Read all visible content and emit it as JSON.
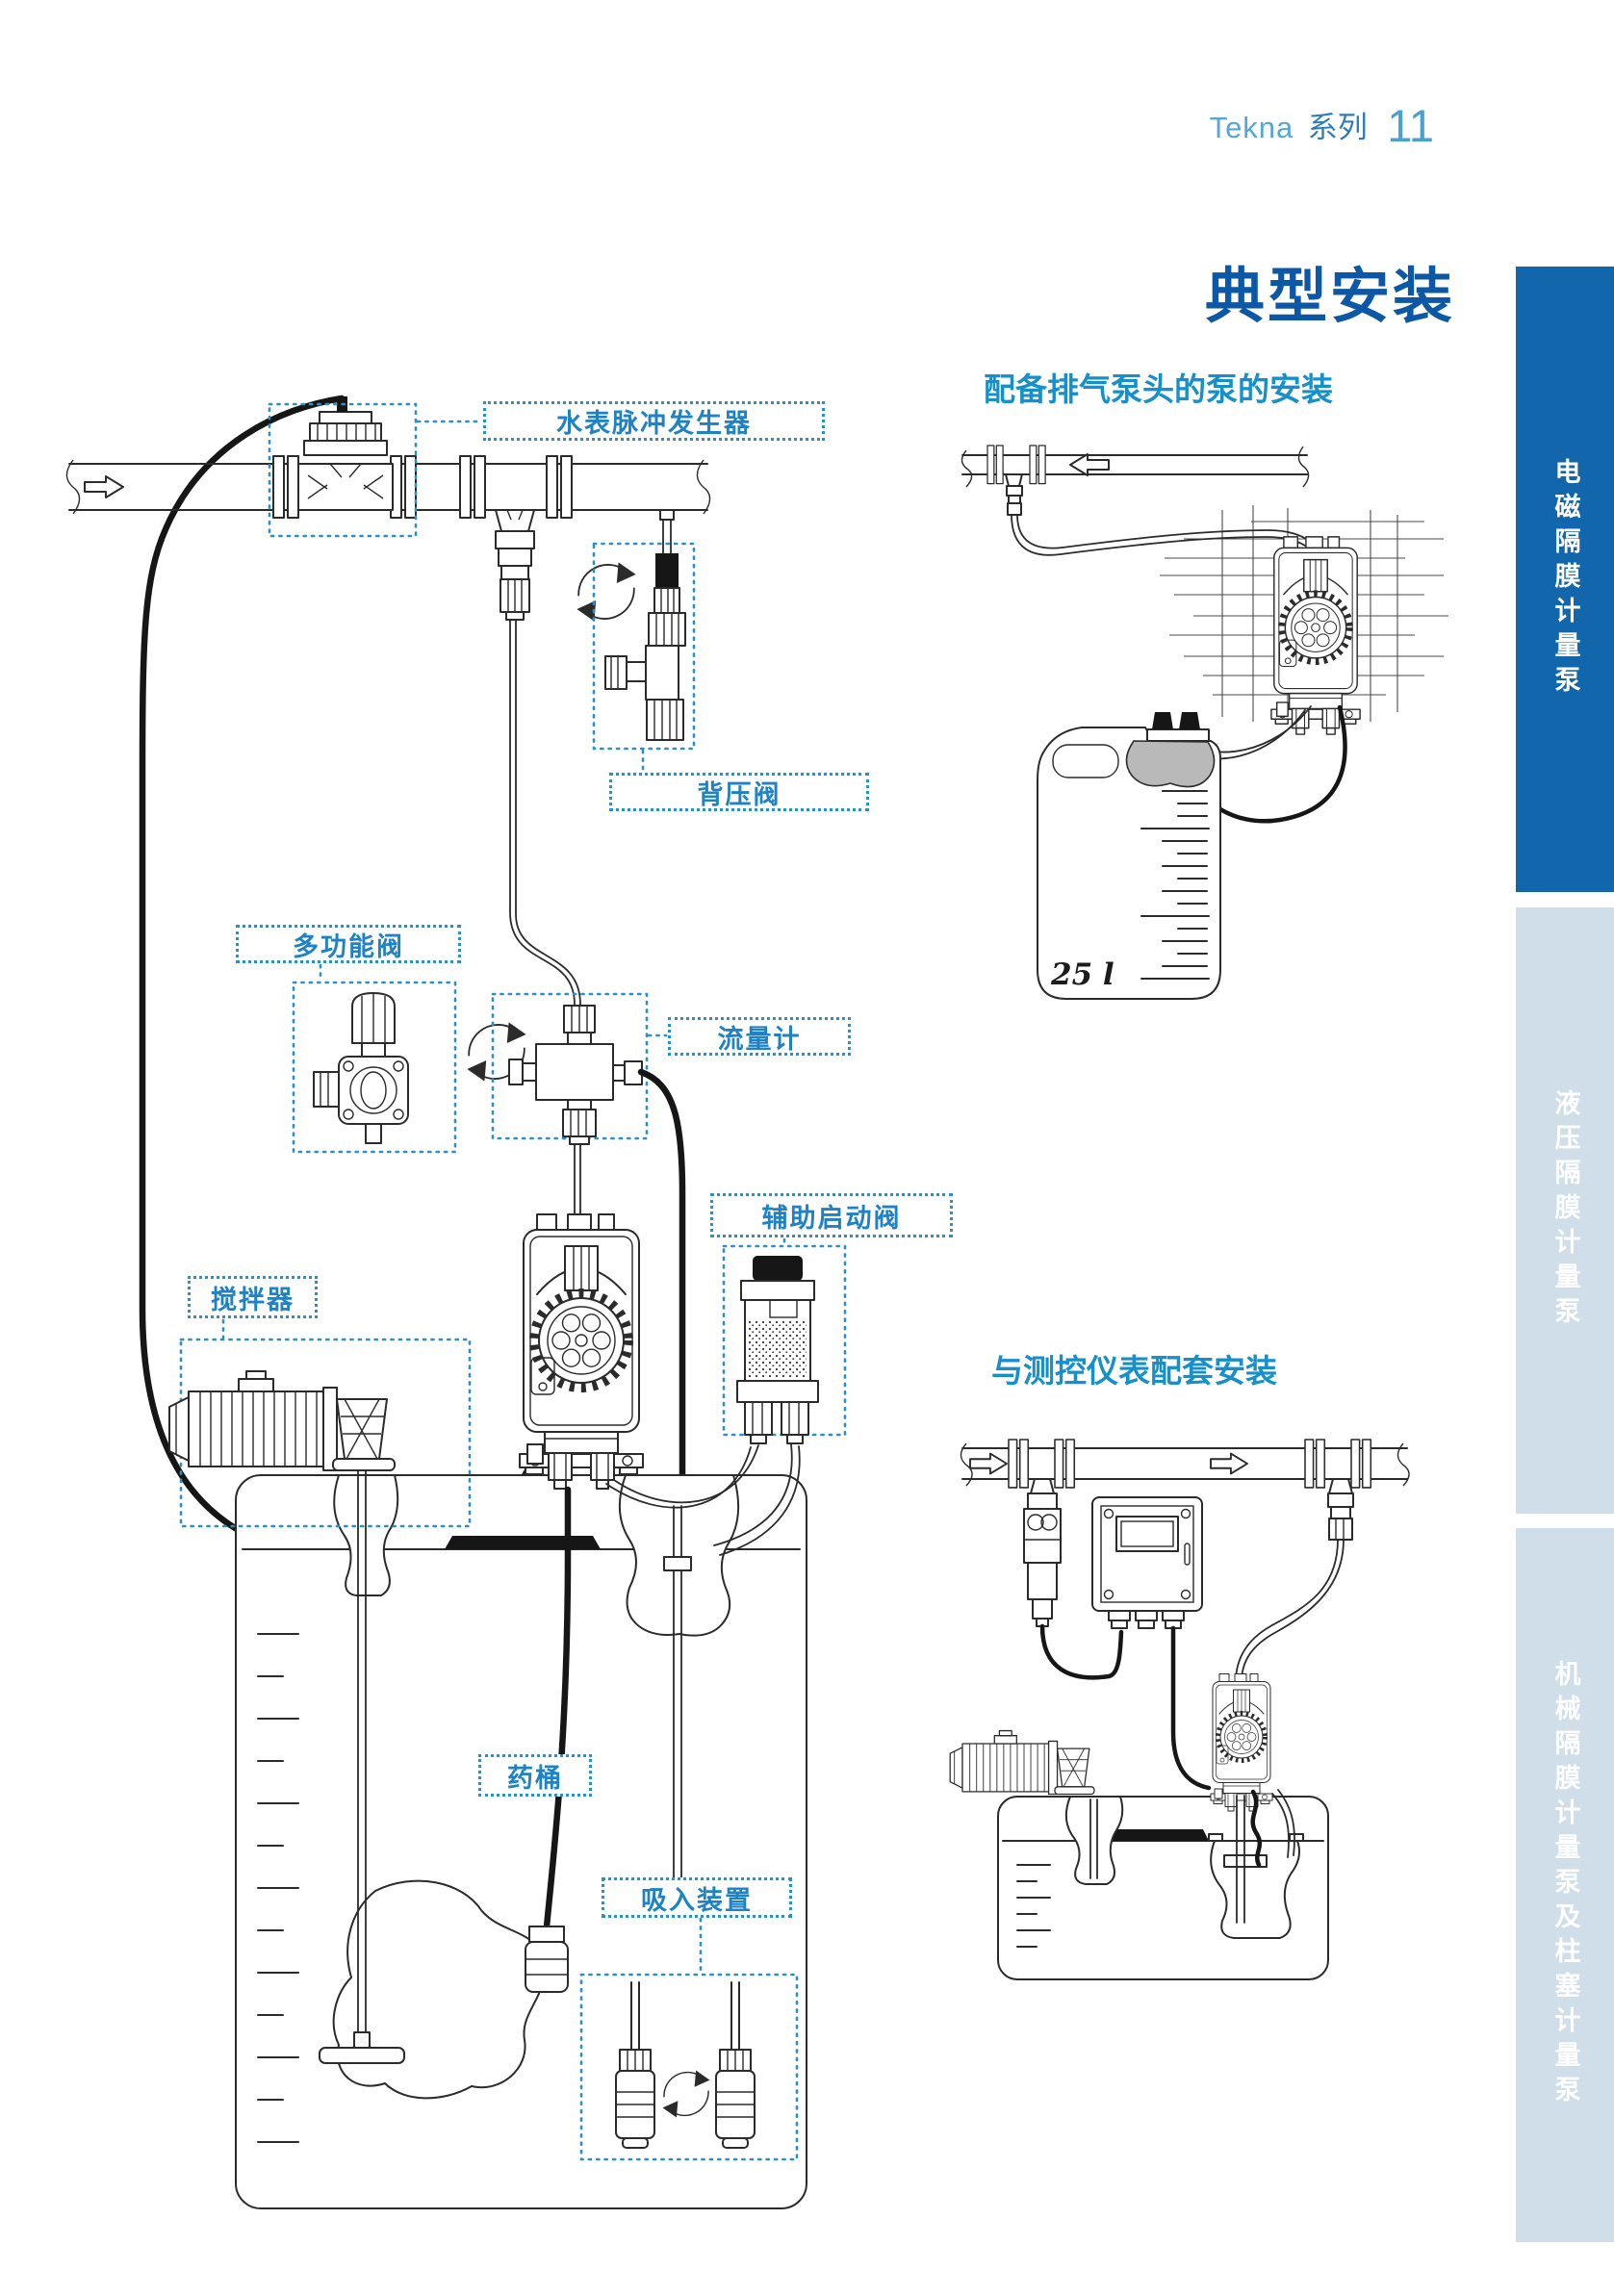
{
  "document": {
    "header": {
      "series": "Tekna",
      "series_suffix": "系列",
      "page_number": "11"
    },
    "page_title": "典型安装",
    "main_diagram": {
      "labels": {
        "water_meter": "水表脉冲发生器",
        "back_pressure_valve": "背压阀",
        "multifunction_valve": "多功能阀",
        "flow_meter": "流量计",
        "auxiliary_priming_valve": "辅助启动阀",
        "agitator": "搅拌器",
        "chemical_tank": "药桶",
        "suction_device": "吸入装置"
      }
    },
    "right_sections": [
      {
        "title": "配备排气泵头的泵的安装",
        "tank_label": "25 l"
      },
      {
        "title": "与测控仪表配套安装"
      }
    ],
    "sidebar_tabs": [
      {
        "label": "电磁隔膜计量泵",
        "active": true,
        "background": "#1166ac",
        "text_color": "#ffffff"
      },
      {
        "label": "液压隔膜计量泵",
        "active": false,
        "background": "#d0dee9",
        "text_color": "#ffffff"
      },
      {
        "label": "机械隔膜计量泵及柱塞计量泵",
        "active": false,
        "background": "#d0dee9",
        "text_color": "#ffffff"
      }
    ],
    "colors": {
      "accent_blue": "#1e82c4",
      "title_blue": "#0d57a7",
      "section_title_blue": "#1590cb",
      "label_border_blue": "#2e8fc6",
      "active_tab_blue": "#1166ac",
      "inactive_tab_blue": "#d0dee9",
      "line_art": "#2b2b2b"
    }
  }
}
